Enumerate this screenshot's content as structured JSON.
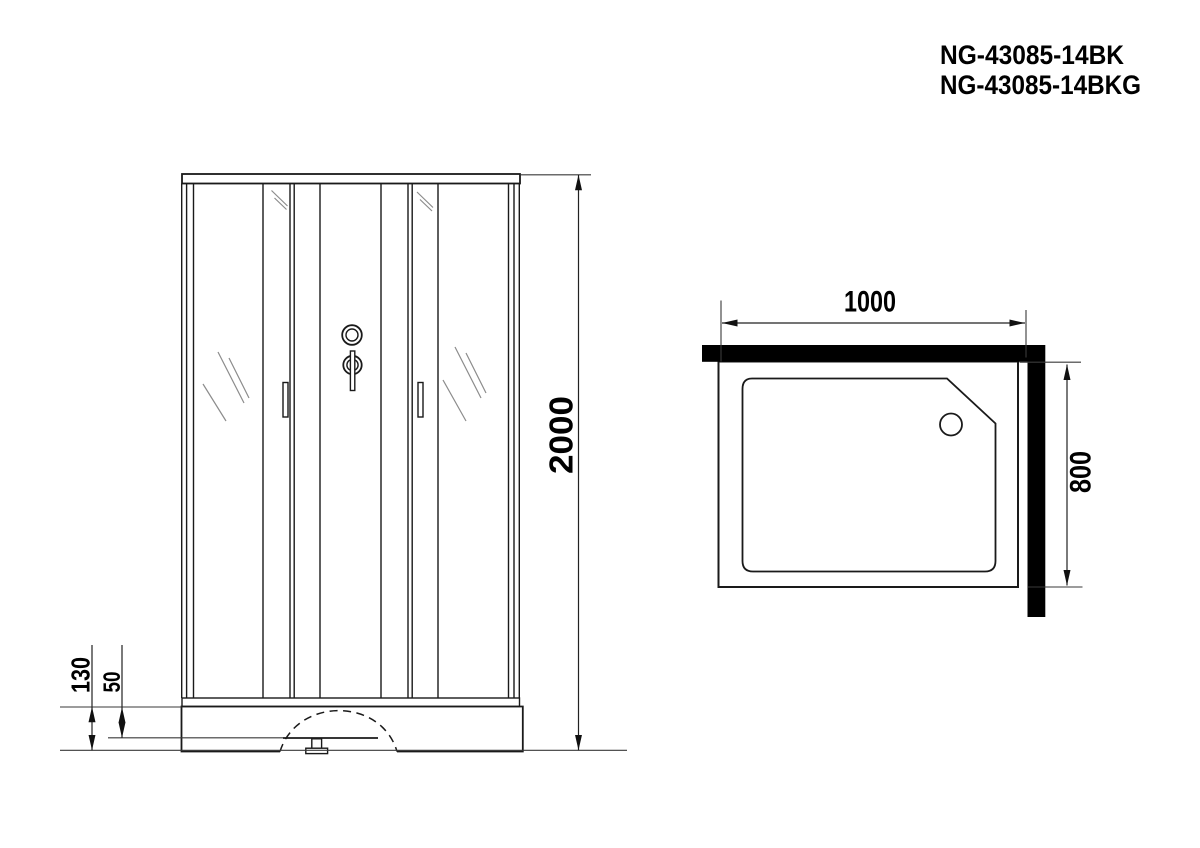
{
  "header": {
    "model_line1": "NG-43085-14BK",
    "model_line2": "NG-43085-14BKG"
  },
  "front_view": {
    "dim_total_height": "2000",
    "dim_base_height": "130",
    "dim_tray_inner_height": "50"
  },
  "plan_view": {
    "dim_width": "1000",
    "dim_depth": "800"
  },
  "colors": {
    "line": "#1a1a1a",
    "wall_fill": "#000000",
    "hatch": "#8c8c8c",
    "text": "#000000",
    "background": "#ffffff"
  }
}
